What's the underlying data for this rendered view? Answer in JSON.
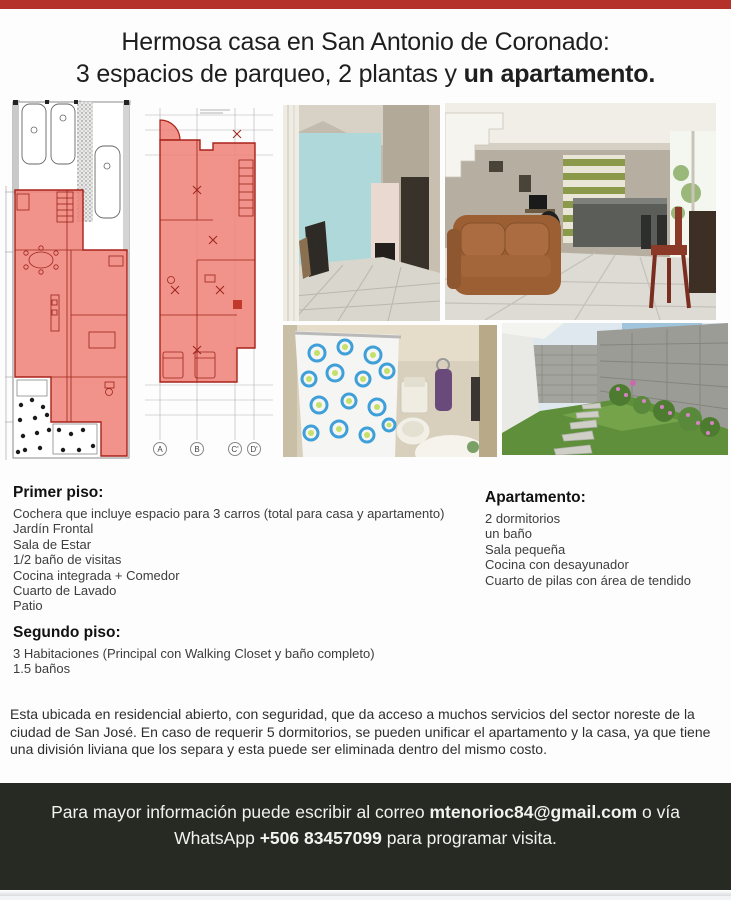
{
  "title": {
    "line1": "Hermosa casa en San Antonio de Coronado:",
    "line2_regular": "3 espacios de parqueo, 2 plantas y ",
    "line2_bold": "un apartamento."
  },
  "colors": {
    "top_bar": "#b43229",
    "plan_highlight": "#ee8076",
    "footer_background": "#262a22"
  },
  "plans": {
    "grid_labels": [
      "A",
      "B",
      "C'",
      "D'"
    ]
  },
  "sections": {
    "primer_piso": {
      "heading": "Primer piso:",
      "items": [
        "Cochera que incluye espacio para 3 carros (total para casa y apartamento)",
        "Jardín Frontal",
        "Sala de Estar",
        "1/2 baño de visitas",
        "Cocina integrada + Comedor",
        "Cuarto de Lavado",
        "Patio"
      ]
    },
    "apartamento": {
      "heading": "Apartamento:",
      "items": [
        "2 dormitorios",
        "un baño",
        "Sala pequeña",
        "Cocina con desayunador",
        "Cuarto de pilas con área de tendido"
      ]
    },
    "segundo_piso": {
      "heading": "Segundo piso:",
      "items": [
        "3 Habitaciones (Principal con Walking Closet y baño completo)",
        "1.5  baños"
      ]
    }
  },
  "description": "Esta ubicada en residencial abierto, con seguridad, que da acceso a muchos servicios del sector noreste de la ciudad de San José.  En caso de requerir 5 dormitorios, se pueden unificar el apartamento y la casa, ya que tiene una división liviana que los separa y esta puede ser eliminada dentro del mismo costo.",
  "footer": {
    "line1_part1": "Para mayor información puede escribir al correo ",
    "line1_bold": "mtenorioc84@gmail.com",
    "line1_part2": " o vía",
    "line2_part1": "WhatsApp ",
    "line2_bold": "+506 83457099",
    "line2_part2": " para programar visita."
  }
}
